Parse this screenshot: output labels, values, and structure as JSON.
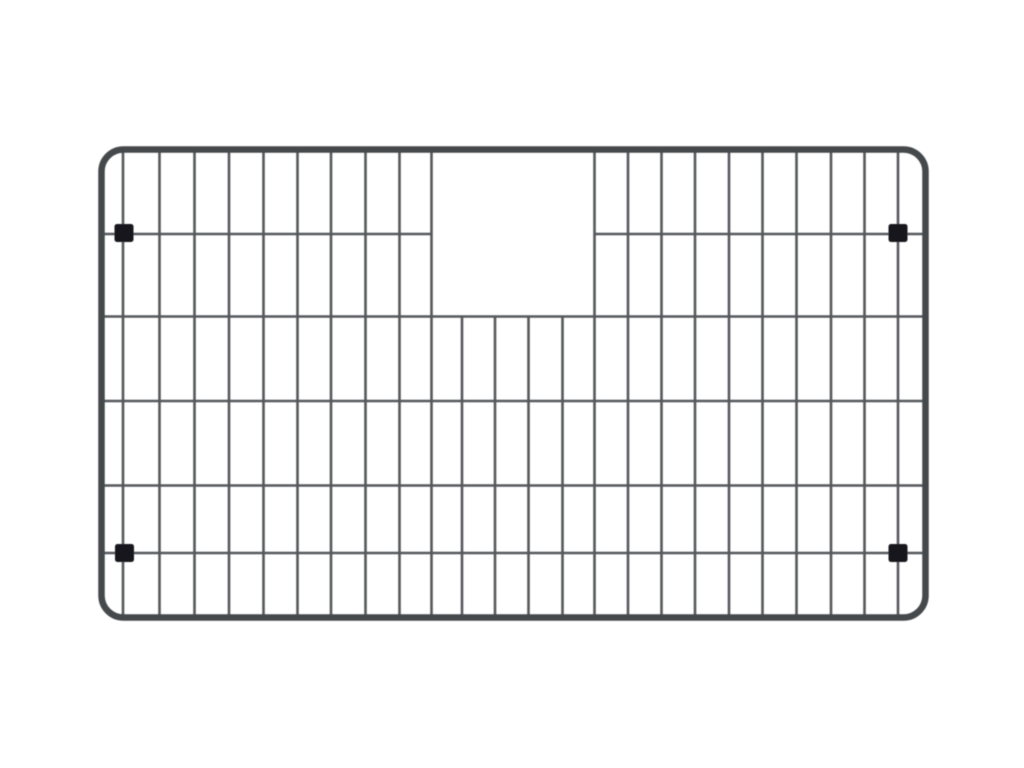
{
  "scene": {
    "subject": "stainless-steel-sink-bottom-grid",
    "background_color": "#ffffff",
    "canvas": {
      "width": 1024,
      "height": 768
    }
  },
  "grid": {
    "frame": {
      "x": 101.5,
      "y": 149.5,
      "width": 824,
      "height": 468,
      "corner_radius": 22,
      "stroke_width": 6.5,
      "color": "#45484c"
    },
    "wire": {
      "stroke_width": 2.6,
      "color": "#55585c"
    },
    "vertical_span": {
      "y1": 149,
      "y2": 619
    },
    "horizontal_span": {
      "x1": 101,
      "x2": 926
    },
    "verticals_full_x": [
      123,
      159.5,
      194.5,
      229,
      263.5,
      297.5,
      331,
      365.5,
      399.5,
      431.5,
      594.5,
      628,
      661.5,
      695,
      729,
      762.5,
      796.5,
      831,
      864.5,
      898
    ],
    "verticals_partial": {
      "x": [
        462,
        495,
        528.5,
        562.5
      ],
      "y_start": 316.5
    },
    "horizontals_full_y": [
      316.5,
      401,
      485.5,
      553
    ],
    "horizontal_split": {
      "y": 234,
      "gap_x1": 431.5,
      "gap_x2": 594.5
    },
    "cutout": {
      "x1": 431.5,
      "x2": 594.5,
      "y_top": 149,
      "y_bottom": 316.5
    },
    "feet": {
      "width": 19,
      "height": 18,
      "corner_radius": 2.5,
      "color": "#18191b",
      "centers": [
        [
          124,
          233
        ],
        [
          898,
          233
        ],
        [
          124.5,
          553
        ],
        [
          898,
          553
        ]
      ]
    }
  }
}
